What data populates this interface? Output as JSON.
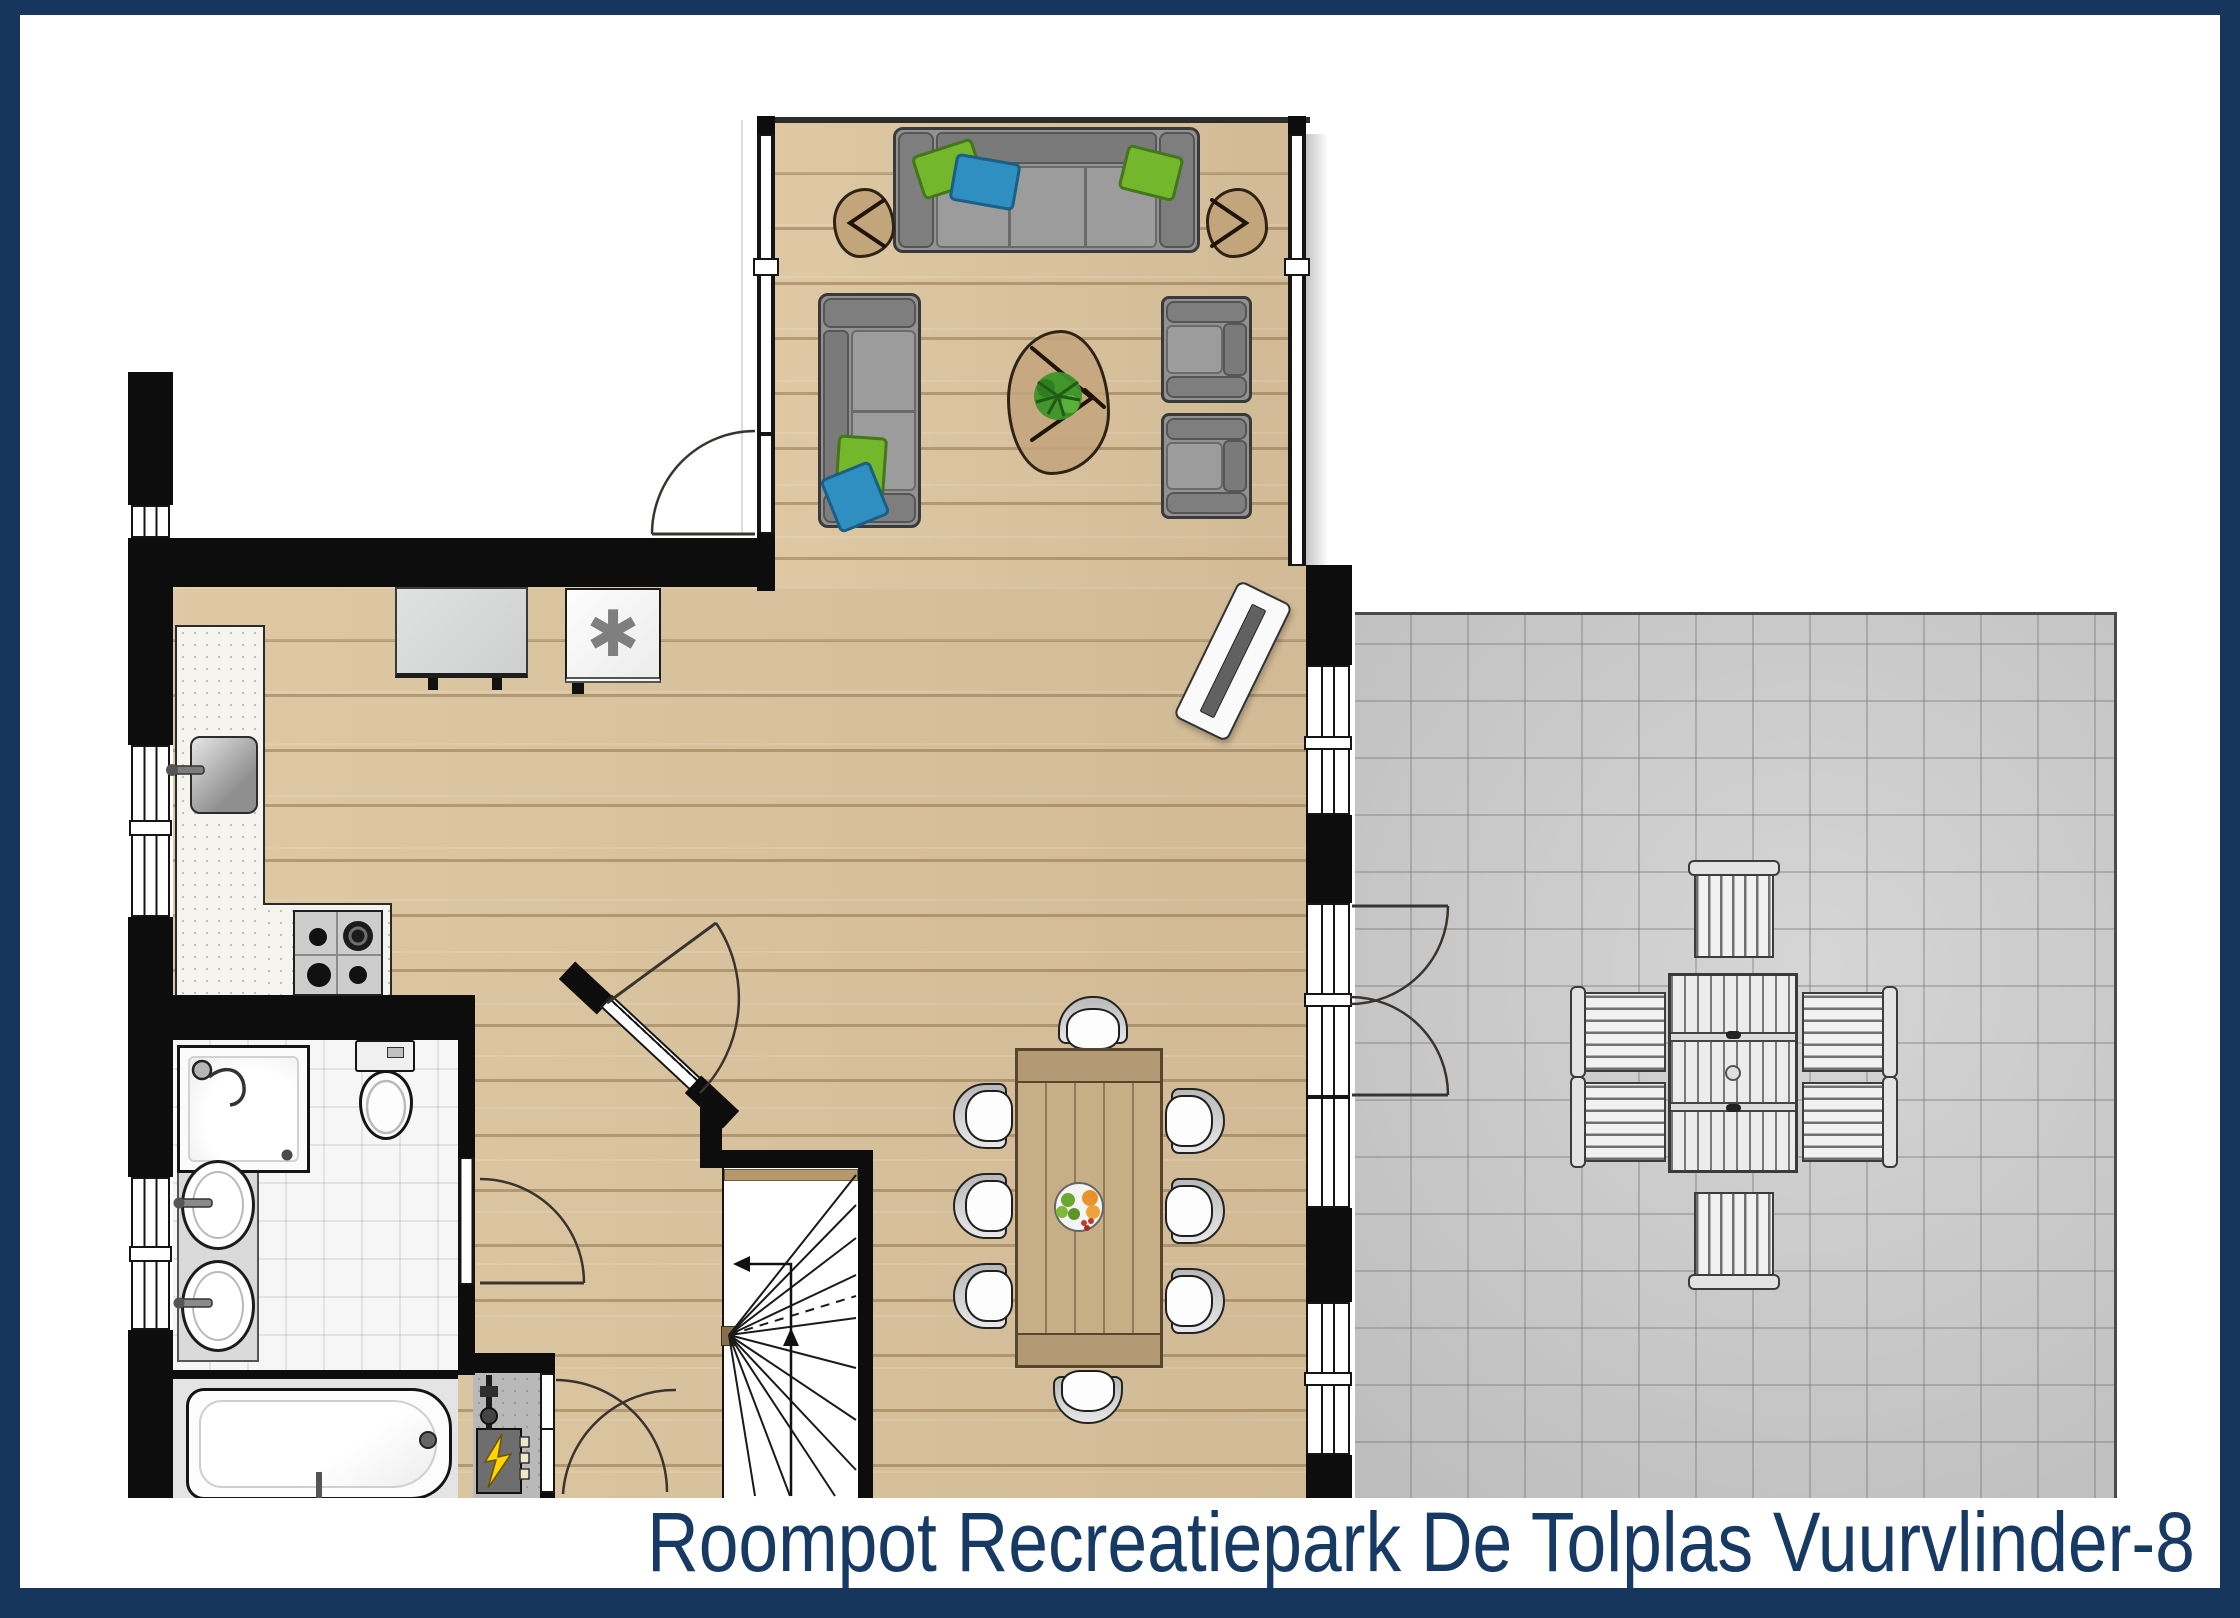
{
  "title": {
    "text": "Roompot Recreatiepark De Tolplas Vuurvlinder-8",
    "color": "#163a64"
  },
  "frame": {
    "color": "#163a64"
  },
  "symbols": {
    "washing_machine": "✱"
  },
  "palette": {
    "wall": "#0d0d0d",
    "wood_floor": "#dcc49d",
    "terrace": "#c8c8c8",
    "bathroom_tile": "#f6f6f6",
    "cushion_green": "#74b62c",
    "cushion_blue": "#2e8fc0",
    "plant_green": "#3c9327",
    "dining_table_wood": "#c6ae86"
  }
}
